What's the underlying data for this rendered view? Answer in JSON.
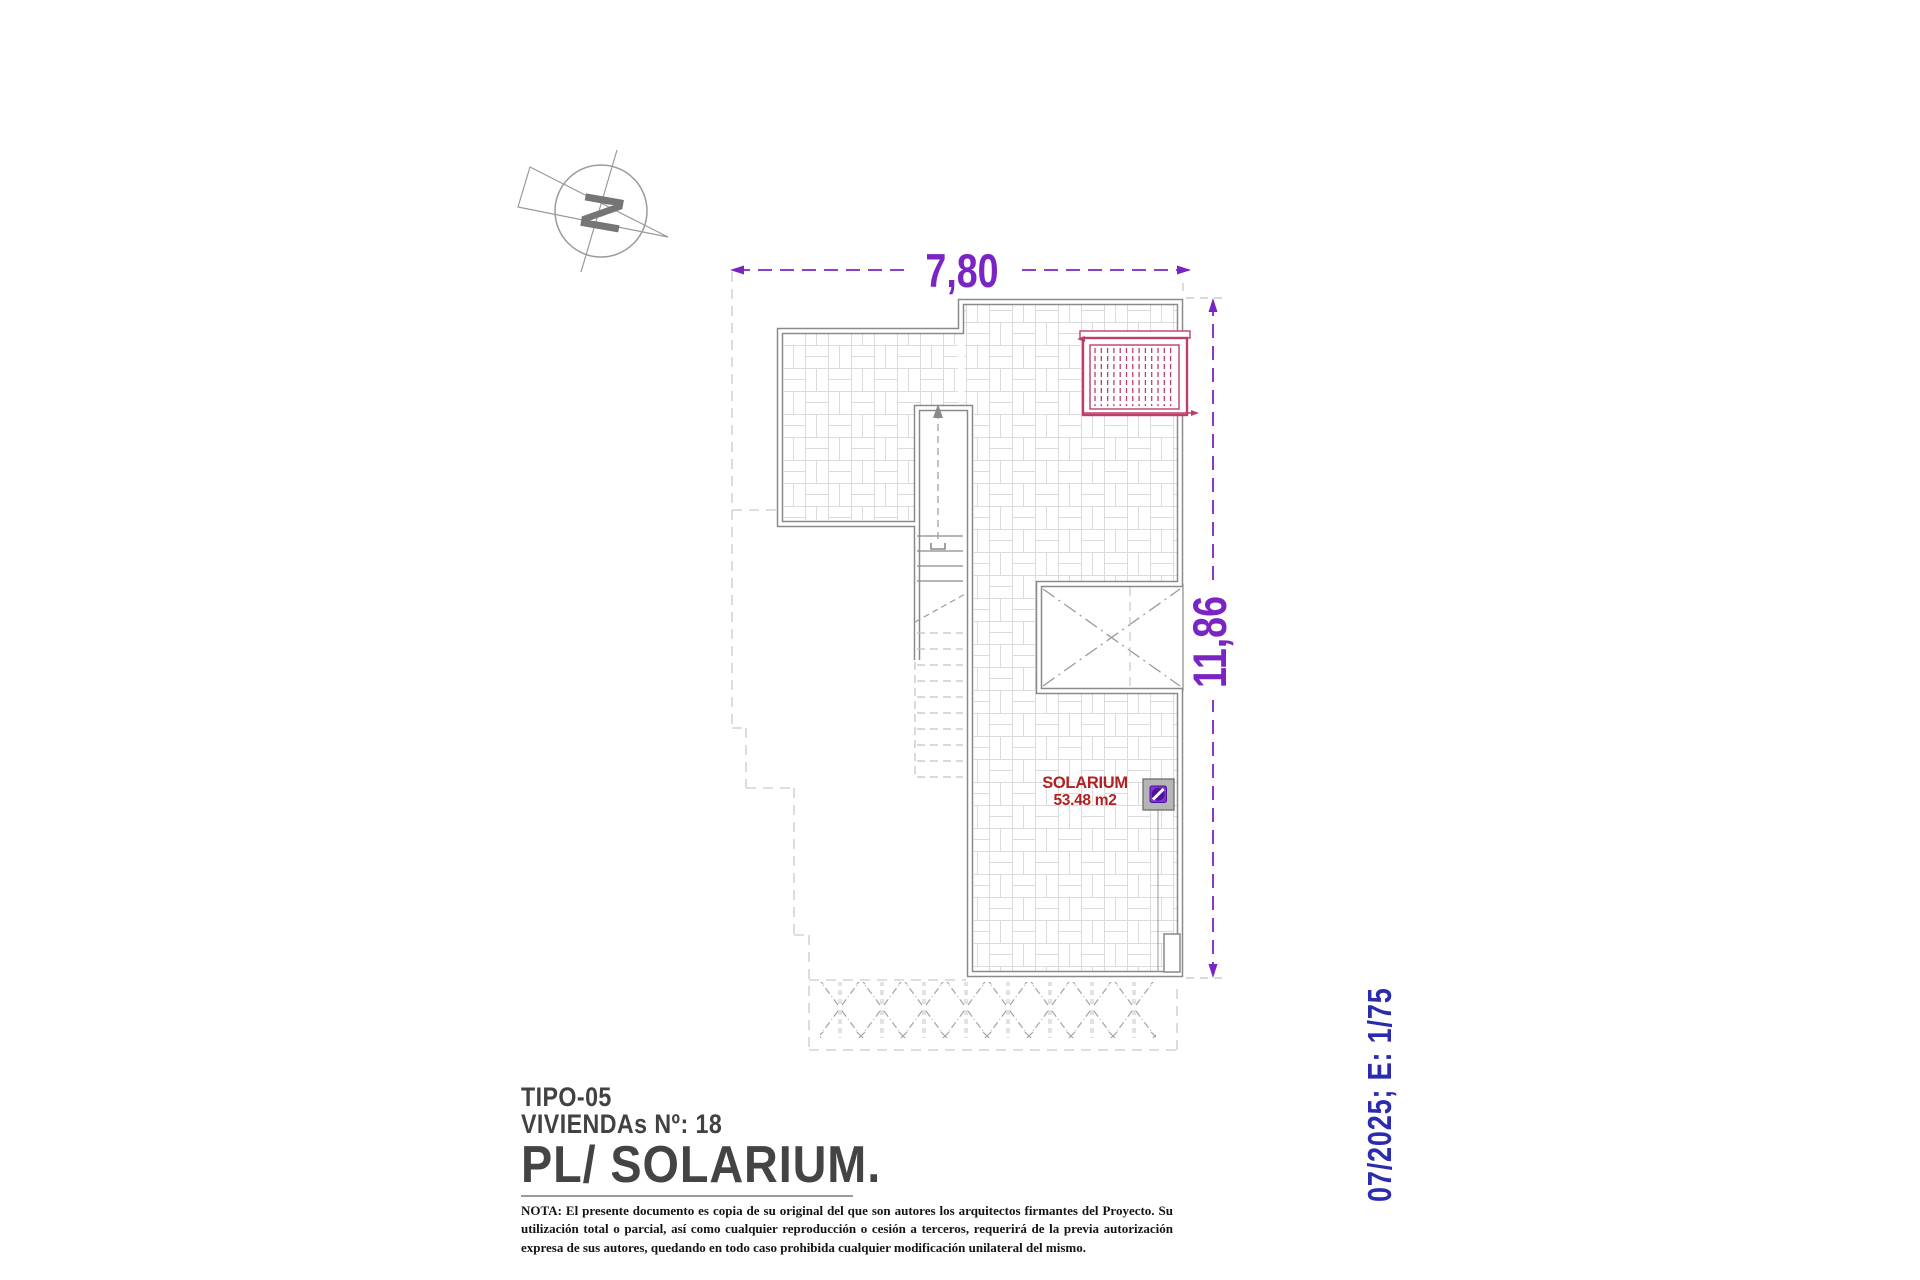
{
  "drawing": {
    "north_letter": "N",
    "dim_width": "7,80",
    "dim_height": "11,86",
    "room_label": "SOLARIUM",
    "room_area": "53.48 m2"
  },
  "title_block": {
    "tipo": "TIPO-05",
    "viviendas": "VIVIENDAs Nº: 18",
    "plan_title": "PL/ SOLARIUM.",
    "nota": "NOTA: El presente documento es copia de su original del que son autores los arquitectos firmantes del Proyecto. Su utilización total o parcial, así como cualquier reproducción o cesión a terceros, requerirá de la previa autorización expresa de sus autores, quedando en todo caso prohibida cualquier modificación unilateral del mismo."
  },
  "side_note": {
    "date_scale": "07/2025; E: 1/75"
  },
  "colors": {
    "dimension_purple": "#7b24c4",
    "pergola_crimson": "#bd3f68",
    "room_red": "#b02222",
    "side_blue": "#2b2bb2",
    "wall_gray": "#8a8a8a"
  }
}
